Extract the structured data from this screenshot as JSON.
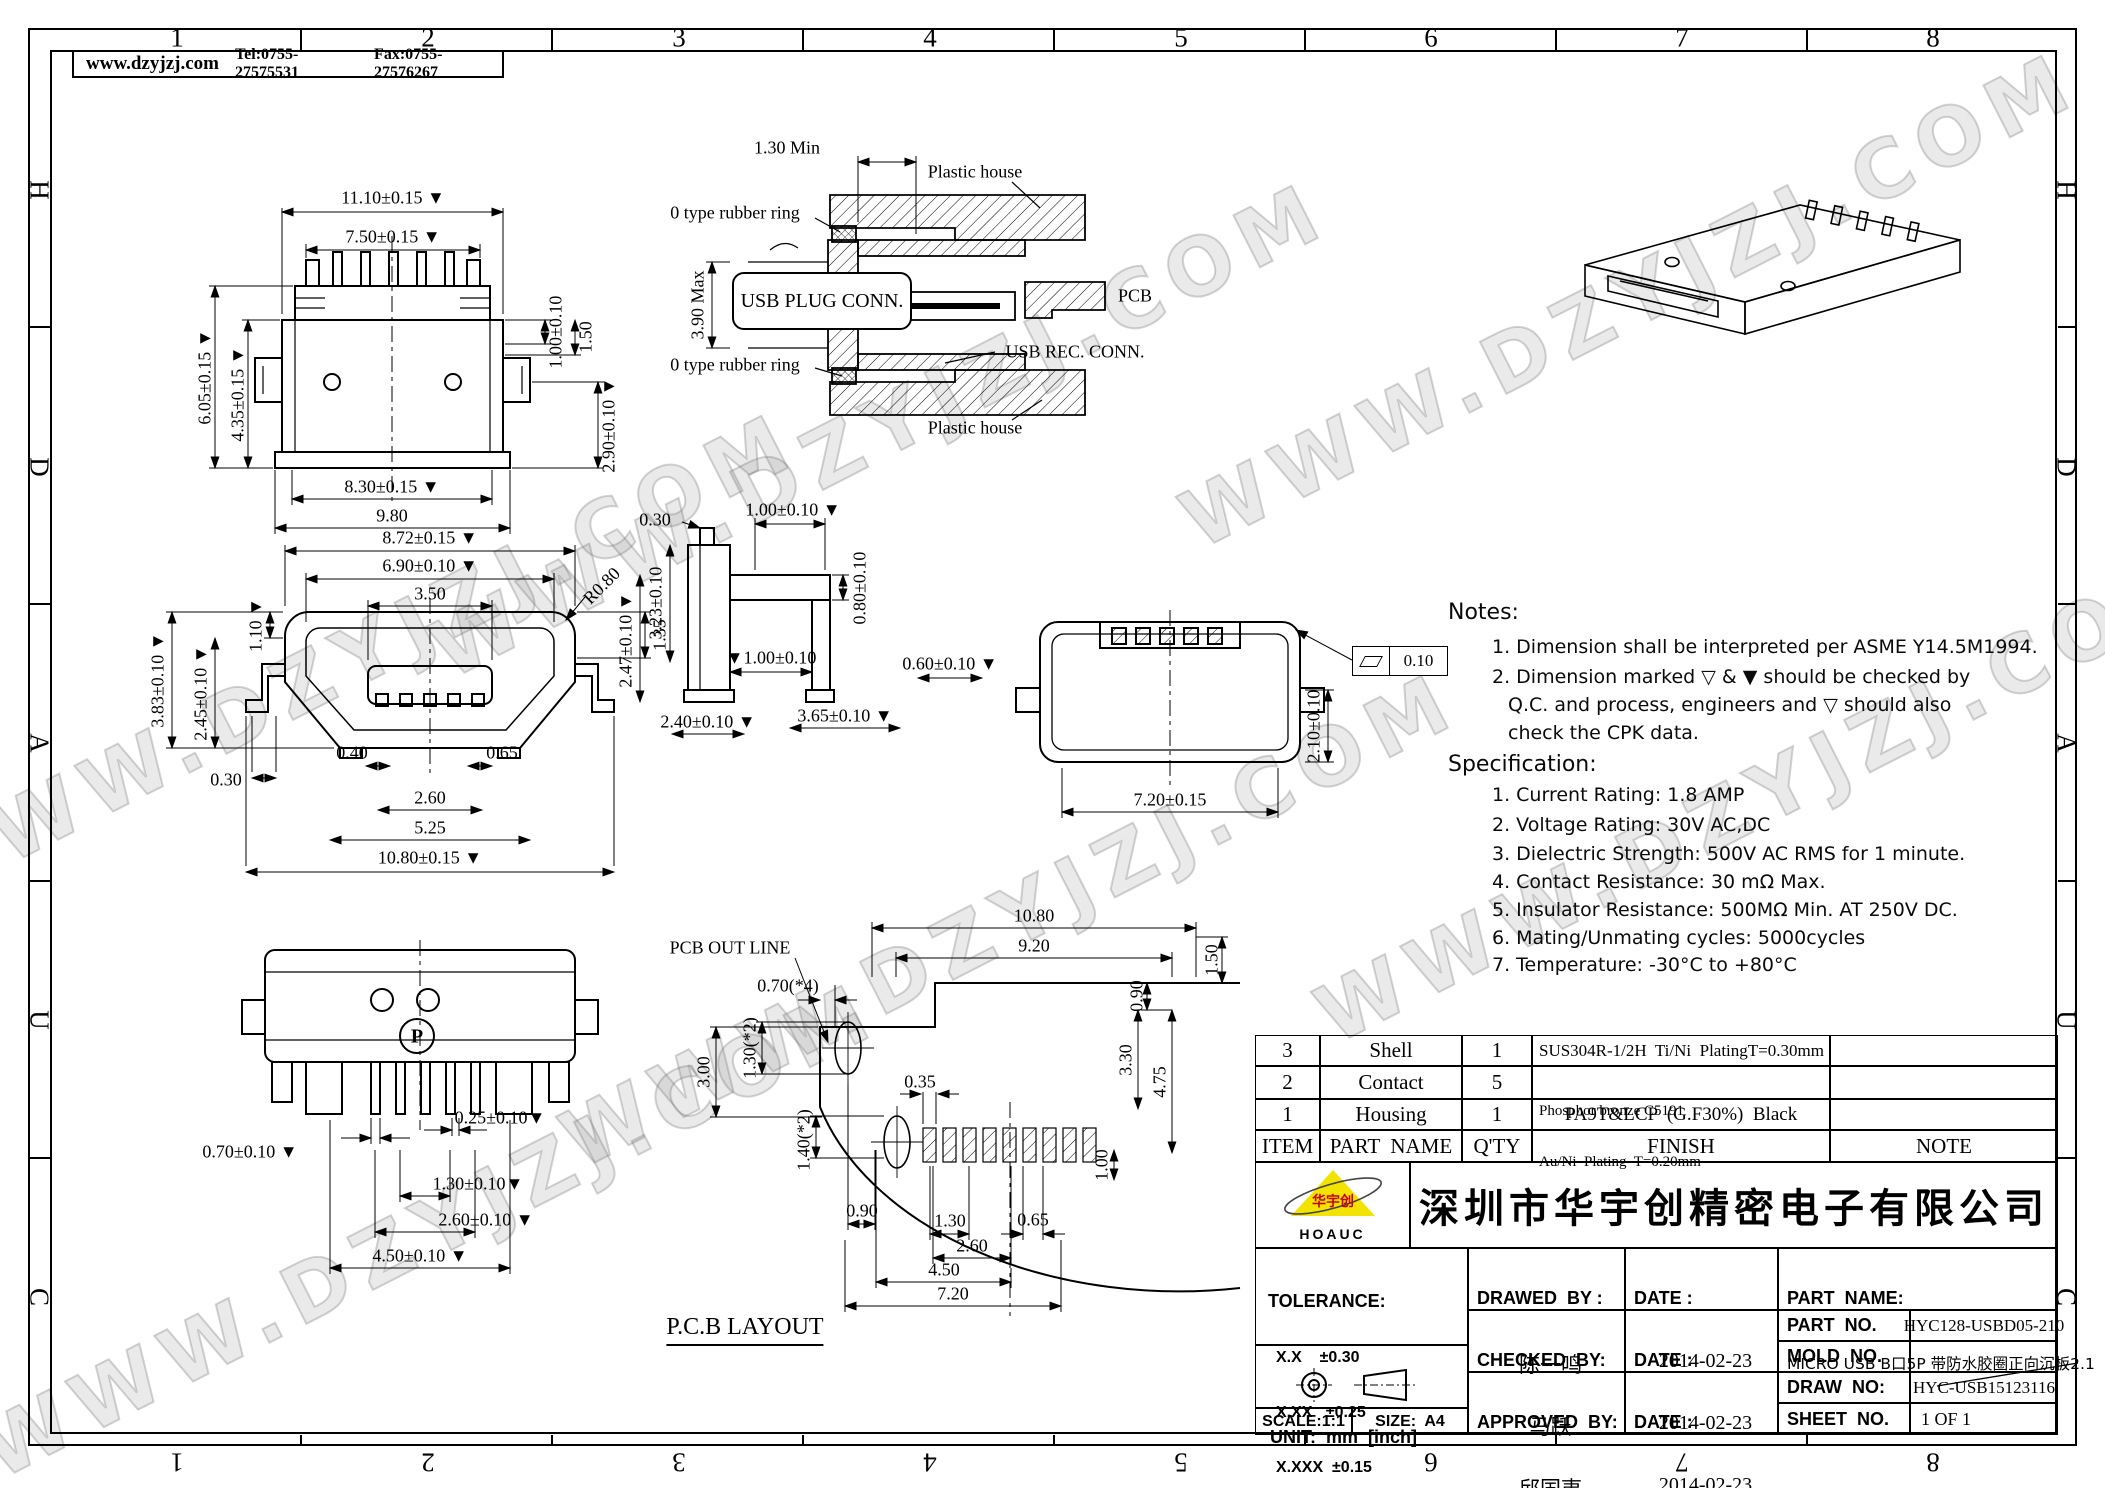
{
  "frame": {
    "top_zones": [
      "1",
      "2",
      "3",
      "4",
      "5",
      "6",
      "7",
      "8"
    ],
    "bottom_zones": [
      "8",
      "7",
      "6",
      "5",
      "4",
      "3",
      "2",
      "1"
    ],
    "left_zones": [
      "H",
      "D",
      "A",
      "U",
      "C"
    ],
    "right_zones": [
      "H",
      "D",
      "A",
      "U",
      "C"
    ]
  },
  "header": {
    "website": "www.dzyjzj.com",
    "tel": "Tel:0755-27575531",
    "fax": "Fax:0755-27576267"
  },
  "wm": {
    "text": "WWW.DZYJZJ.COM"
  },
  "dims": {
    "v1": [
      "11.10±0.15 ▼",
      "7.50±0.15 ▼",
      "1.00±0.10",
      "1.50",
      "6.05±0.15 ▼",
      "4.35±0.15 ▼",
      "2.90±0.10 ▼",
      "8.30±0.15 ▼",
      "9.80"
    ],
    "v2": [
      "1.30 Min",
      "Plastic house",
      "0 type rubber ring",
      "USB PLUG CONN.",
      "3.90 Max",
      "PCB",
      "USB REC.  CONN.",
      "0 type rubber ring",
      "Plastic house"
    ],
    "v4": [
      "8.72±0.15 ▼",
      "6.90±0.10 ▼",
      "3.50",
      "R0.80",
      "1.35",
      "1.10 ▼",
      "3.83±0.10 ▼",
      "2.45±0.10 ▼",
      "0.30",
      "0.40",
      "0.65",
      "2.60",
      "5.25",
      "10.80±0.15 ▼"
    ],
    "v5": [
      "0.30",
      "1.00±0.10 ▼",
      "0.80±0.10",
      "3.23±0.10",
      "2.47±0.10 ▼",
      "▼1.00±0.10",
      "2.40±0.10 ▼",
      "3.65±0.10 ▼",
      "0.60±0.10 ▼"
    ],
    "v6": [
      "7.20±0.15",
      "2.10±0.10",
      "0.10"
    ],
    "v7": [
      "0.70±0.10 ▼",
      "0.25±0.10▼",
      "1.30±0.10▼",
      "2.60±0.10 ▼",
      "4.50±0.10 ▼",
      "P"
    ],
    "v8": [
      "PCB OUT LINE",
      "10.80",
      "9.20",
      "0.70(*4)",
      "1.50",
      "0.90",
      "3.00",
      "1.30(*2)",
      "0.35",
      "3.30",
      "4.75",
      "1.40(*2)",
      "1.00",
      "0.90",
      "1.30",
      "0.65",
      "2.60",
      "4.50",
      "7.20",
      "P.C.B LAYOUT"
    ]
  },
  "notes": {
    "title": "Notes:",
    "lines": [
      "1. Dimension shall be interpreted per ASME Y14.5M1994.",
      "2. Dimension marked ▽ & ▼ should be checked by",
      "Q.C. and process, engineers and ▽ should also",
      "check the CPK data."
    ]
  },
  "spec": {
    "title": "Specification:",
    "items": [
      "1. Current Rating: 1.8 AMP",
      "2. Voltage Rating: 30V AC,DC",
      "3. Dielectric Strength: 500V AC RMS for 1 minute.",
      "4. Contact Resistance: 30 mΩ Max.",
      "5. Insulator Resistance: 500MΩ Min. AT 250V DC.",
      "6. Mating/Unmating cycles: 5000cycles",
      "7. Temperature: -30°C to +80°C"
    ]
  },
  "table": {
    "headers": {
      "item": "ITEM",
      "name": "PART  NAME",
      "qty": "Q'TY",
      "finish": "FINISH",
      "note": "NOTE"
    },
    "rows": [
      {
        "item": "3",
        "name": "Shell",
        "qty": "1",
        "finish1": "SUS304R-1/2H  Ti/Ni  PlatingT=0.30mm",
        "finish2": "",
        "note": ""
      },
      {
        "item": "2",
        "name": "Contact",
        "qty": "5",
        "finish1": "Phosphor bronze C5191",
        "finish2": "Au/Ni  Plating  T=0.20mm",
        "note": ""
      },
      {
        "item": "1",
        "name": "Housing",
        "qty": "1",
        "finish1": "PA9T&LCP  (G.F30%)  Black",
        "finish2": "",
        "note": ""
      }
    ]
  },
  "tb": {
    "logo_cn": "华宇创",
    "logo_en": "HOAUC",
    "company": "深圳市华宇创精密电子有限公司",
    "tolerance_label": "TOLERANCE:",
    "tol1": "X.X    ±0.30",
    "tol2": "X.XX   ±0.25",
    "tol3": "X.XXX  ±0.15",
    "tol4": "X.°  ±2°",
    "tol5": "X.X°  ±0.5°",
    "unit": "UNIT:  mm  [inch]",
    "scale": "SCALE:1:1",
    "size": "SIZE:  A4",
    "drawn_label": "DRAWED  BY :",
    "drawn_name": "陈一鸣",
    "checked_label": "CHECKED  BY:",
    "checked_name": "马跃",
    "approved_label": "APPROVED  BY:",
    "approved_name": "邱国夷",
    "date_label": "DATE :",
    "date1": "2014-02-23",
    "date2": "2014-02-23",
    "date3": "2014-02-23",
    "part_name_label": "PART  NAME:",
    "part_name": "MICRO USB B口5P 带防水胶圈正向沉板2.1",
    "part_no_label": "PART  NO.",
    "part_no": "HYC128-USBD05-210",
    "mold_no_label": "MOLD  NO.",
    "draw_no_label": "DRAW  NO:",
    "draw_no": "HYC-USB15123116",
    "sheet_no_label": "SHEET  NO.",
    "sheet_no": "1 OF 1"
  }
}
